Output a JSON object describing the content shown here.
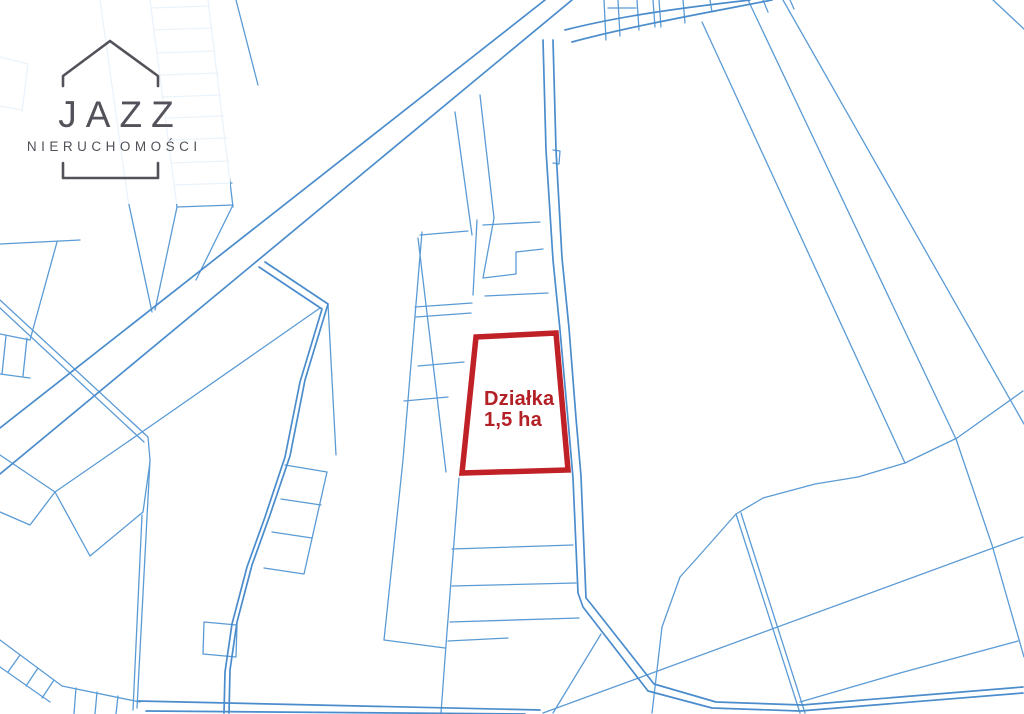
{
  "page": {
    "width": 1024,
    "height": 714,
    "background": "#ffffff"
  },
  "logo": {
    "word": "JAZZ",
    "subtitle": "NIERUCHOMOŚCI",
    "color": "#53525a",
    "house_icon": "house-outline",
    "bracket_icon": "open-bracket"
  },
  "parcel_label": {
    "line1": "Działka",
    "line2": "1,5 ha",
    "color": "#b32025"
  },
  "map": {
    "colors": {
      "road": "#4a8ccc",
      "boundary": "#5b9bd5",
      "highlight": "#c02127",
      "highlight_fill": "#ffffff"
    },
    "highlight_parcel": {
      "path": "M476,337 L556,333 L568,470 L462,473 Z",
      "stroke_width": 5.5
    },
    "roads": [
      "M545,0 L0,428",
      "M572,0 L0,474",
      "M543,40 L546,150 L553,260 L560,330 L568,420 L573,478 L578,593 L583,607 L648,691 L712,708 L800,711 L1023,693",
      "M553,40 L556,150 L562,258 L569,328 L576,418 L581,476 L586,598 L591,604 L654,684 L716,702 L802,705 L1023,687",
      "M565,30 C620,16 680,8 750,0",
      "M572,42 C632,26 700,14 772,0",
      "M265,262 L328,304 L305,380 L290,456 L270,515 L252,565 L237,622 L230,670 L229,713",
      "M259,267 L322,309 L300,382 L285,457 L265,517 L247,567 L232,624 L225,672 L224,713",
      "M138,701 L540,710",
      "M146,711 L525,714"
    ],
    "boundaries": [
      "M151,8 L209,6",
      "M154,30 L212,28",
      "M157,53 L215,51",
      "M160,75 L218,73",
      "M163,97 L221,95",
      "M166,118 L224,116",
      "M169,140 L227,138",
      "M172,163 L229,161",
      "M175,185 L232,183",
      "M150,0 L177,207",
      "M208,0 L233,207",
      "M177,207 L233,205",
      "M177,207 L155,310",
      "M233,205 L196,280",
      "M100,0 L128,200 L152,312",
      "M236,0 L258,85",
      "M0,57 L28,64",
      "M28,64 L22,112",
      "M0,106 L22,110",
      "M0,244 L80,240",
      "M57,242 L30,340",
      "M0,334 L30,340",
      "M6,336 L2,374",
      "M27,338 L23,376",
      "M0,374 L30,378",
      "M0,300 L148,437 L150,460",
      "M0,308 L144,442",
      "M320,308 L155,423 L55,492",
      "M0,455 L55,492",
      "M55,492 L30,525 L0,512",
      "M55,492 L90,556",
      "M143,512 L90,556",
      "M143,512 L150,462",
      "M150,460 L137,708",
      "M142,515 L133,710",
      "M0,640 L62,686",
      "M0,667 L50,702",
      "M20,655 L8,672",
      "M38,668 L26,686",
      "M54,680 L42,698",
      "M62,686 L140,702",
      "M76,688 L74,714",
      "M97,692 L95,714",
      "M118,696 L116,714",
      "M204,622 L237,625 L236,657 L203,654 Z",
      "M285,465 L327,472",
      "M281,499 L321,505",
      "M272,532 L312,538",
      "M264,568 L304,574",
      "M327,472 L304,574",
      "M422,232 L403,460 L384,640",
      "M384,640 L445,648",
      "M328,304 L336,455",
      "M418,238 L446,472",
      "M459,478 L446,645 L441,713",
      "M420,235 L468,231",
      "M415,307 L472,303",
      "M416,317 L471,313",
      "M418,366 L464,362",
      "M404,401 L448,397",
      "M452,549 L573,545",
      "M452,586 L576,583",
      "M450,622 L579,618",
      "M448,641 L508,638",
      "M455,112 L472,235",
      "M480,95 L494,218",
      "M483,225 L540,222",
      "M483,278 L516,274 L516,252 L543,249",
      "M485,296 L548,293",
      "M494,218 L483,278",
      "M477,220 L473,295",
      "M553,150 L560,151 L559,164 L553,163",
      "M604,0 L606,40",
      "M618,0 L620,36",
      "M637,0 L639,30",
      "M653,0 L655,27",
      "M659,0 L661,27",
      "M683,0 L685,23",
      "M608,8 L636,8",
      "M710,0 L712,12",
      "M763,0 L768,12",
      "M790,0 L794,9",
      "M702,22 L905,463",
      "M748,0 L956,439 L992,545 L1024,657",
      "M783,0 L1024,424",
      "M993,0 L1024,29",
      "M1023,391 L957,438 L905,463 L858,477 L815,484 L763,498 L736,514 L698,557 L680,577 L662,627 L652,713",
      "M736,514 L800,713",
      "M741,513 L805,713",
      "M543,713 L1023,537",
      "M553,713 L601,634",
      "M1018,641 L900,673 L800,702"
    ]
  }
}
